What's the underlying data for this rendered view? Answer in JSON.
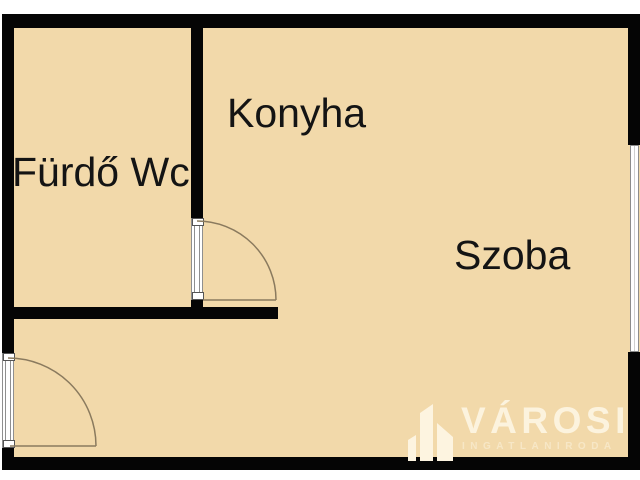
{
  "colors": {
    "page_bg": "#ffffff",
    "floor": "#f2d9aa",
    "wall": "#050505",
    "door_edge": "#8f8f8f",
    "door_arc": "#8a7a5e",
    "window_edge": "#8c8c8c",
    "label_text": "#141414",
    "logo_text": "#fcf3de",
    "logo_subtext": "#f7e7c6"
  },
  "rooms": [
    {
      "id": "bathroom",
      "label": "Fürdő Wc"
    },
    {
      "id": "kitchen",
      "label": "Konyha"
    },
    {
      "id": "room",
      "label": "Szoba"
    }
  ],
  "watermark": {
    "brand": "VÁROSI",
    "tagline": "INGATLANIRODA",
    "icon": "buildings-icon"
  }
}
